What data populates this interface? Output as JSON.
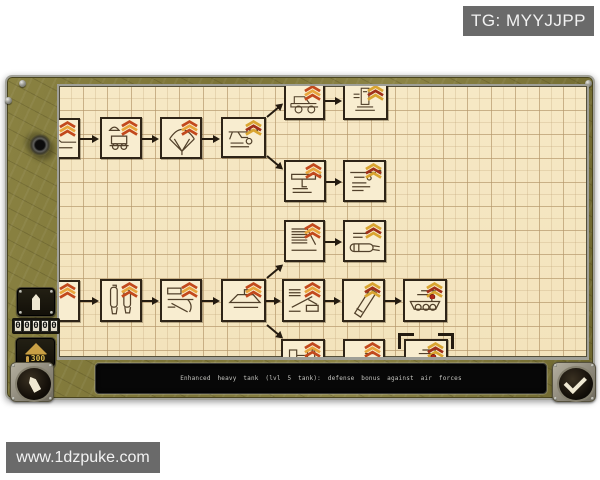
{
  "watermarks": {
    "top_right": "TG: MYYJJPP",
    "bottom_left": "www.1dzpuke.com"
  },
  "status_bar": {
    "text": "Enhanced heavy tank (lvl 5 tank): defense bonus against air forces"
  },
  "sidebar": {
    "unit_button": {
      "icon": "shell-icon"
    },
    "counter": {
      "digits": [
        "0",
        "0",
        "0",
        "0",
        "0"
      ]
    },
    "resource_badge": {
      "value": "300",
      "icon": "supply-pile-icon"
    },
    "back_button": {
      "icon": "shell-back-icon"
    }
  },
  "confirm_button": {
    "icon": "checkmark-icon"
  },
  "colors": {
    "grid_bg": "#f6e8c5",
    "grid_line": "#a68658",
    "frame_olive": "#7b7336",
    "node_border": "#2e2417",
    "insignia_orange": "#c2491d",
    "insignia_gold": "#d9a430",
    "status_text": "#c6c6c2",
    "watermark_bg": "#6a6a6a"
  },
  "tech_tree": {
    "selected_node": "f3",
    "nodes": [
      {
        "id": "a1",
        "icon": "vehicle",
        "insignia": "orange",
        "x": -20,
        "y": 32,
        "w": 41,
        "h": 41,
        "selected": false
      },
      {
        "id": "a2",
        "icon": "airborne-vehicle",
        "insignia": "orange",
        "x": 41,
        "y": 31,
        "w": 42,
        "h": 42,
        "selected": false
      },
      {
        "id": "a3",
        "icon": "parachute",
        "insignia": "orange",
        "x": 101,
        "y": 31,
        "w": 42,
        "h": 42,
        "selected": false
      },
      {
        "id": "a4",
        "icon": "rifle",
        "insignia": "gold",
        "x": 162,
        "y": 31,
        "w": 45,
        "h": 41,
        "selected": false
      },
      {
        "id": "b1a",
        "icon": "truck",
        "insignia": "orange",
        "x": 225,
        "y": -4,
        "w": 41,
        "h": 38,
        "selected": false
      },
      {
        "id": "b1b",
        "icon": "machinery",
        "insignia": "gold",
        "x": 284,
        "y": -4,
        "w": 45,
        "h": 38,
        "selected": false
      },
      {
        "id": "b2a",
        "icon": "smg",
        "insignia": "orange",
        "x": 225,
        "y": 74,
        "w": 42,
        "h": 42,
        "selected": false
      },
      {
        "id": "b2b",
        "icon": "rifle2",
        "insignia": "gold",
        "x": 284,
        "y": 74,
        "w": 43,
        "h": 42,
        "selected": false
      },
      {
        "id": "c1",
        "icon": "radiator",
        "insignia": "orange",
        "x": 225,
        "y": 134,
        "w": 41,
        "h": 42,
        "selected": false
      },
      {
        "id": "c2",
        "icon": "torpedo",
        "insignia": "gold",
        "x": 284,
        "y": 134,
        "w": 43,
        "h": 42,
        "selected": false
      },
      {
        "id": "d1",
        "icon": "partial",
        "insignia": "orange",
        "x": -20,
        "y": 194,
        "w": 41,
        "h": 42,
        "selected": false
      },
      {
        "id": "d2",
        "icon": "bombs",
        "insignia": "orange",
        "x": 41,
        "y": 193,
        "w": 42,
        "h": 43,
        "selected": false
      },
      {
        "id": "d3",
        "icon": "artillery",
        "insignia": "orange",
        "x": 101,
        "y": 193,
        "w": 42,
        "h": 43,
        "selected": false
      },
      {
        "id": "d4",
        "icon": "boat",
        "insignia": "orange",
        "x": 162,
        "y": 193,
        "w": 45,
        "h": 43,
        "selected": false
      },
      {
        "id": "e1",
        "icon": "at-gun",
        "insignia": "orange",
        "x": 223,
        "y": 193,
        "w": 43,
        "h": 43,
        "selected": false
      },
      {
        "id": "e2",
        "icon": "barrel",
        "insignia": "gold",
        "x": 283,
        "y": 193,
        "w": 43,
        "h": 43,
        "selected": false
      },
      {
        "id": "e3",
        "icon": "tank",
        "insignia": "gold-star",
        "x": 344,
        "y": 193,
        "w": 44,
        "h": 43,
        "selected": false
      },
      {
        "id": "f1",
        "icon": "tank-front",
        "insignia": "orange",
        "x": 222,
        "y": 253,
        "w": 44,
        "h": 40,
        "selected": false
      },
      {
        "id": "f2",
        "icon": "sketch",
        "insignia": "orange",
        "x": 284,
        "y": 253,
        "w": 42,
        "h": 40,
        "selected": false
      },
      {
        "id": "f3",
        "icon": "tank",
        "insignia": "gold-star",
        "x": 345,
        "y": 253,
        "w": 44,
        "h": 40,
        "selected": true
      }
    ],
    "arrows": [
      {
        "x": 21,
        "y": 52,
        "len": 13,
        "angle": 0
      },
      {
        "x": 83,
        "y": 52,
        "len": 11,
        "angle": 0
      },
      {
        "x": 143,
        "y": 52,
        "len": 12,
        "angle": 0
      },
      {
        "x": 266,
        "y": 14,
        "len": 11,
        "angle": 0
      },
      {
        "x": 267,
        "y": 95,
        "len": 10,
        "angle": 0
      },
      {
        "x": 266,
        "y": 155,
        "len": 11,
        "angle": 0
      },
      {
        "x": 21,
        "y": 214,
        "len": 13,
        "angle": 0
      },
      {
        "x": 83,
        "y": 214,
        "len": 11,
        "angle": 0
      },
      {
        "x": 143,
        "y": 214,
        "len": 12,
        "angle": 0
      },
      {
        "x": 207,
        "y": 214,
        "len": 9,
        "angle": 0
      },
      {
        "x": 266,
        "y": 214,
        "len": 10,
        "angle": 0
      },
      {
        "x": 326,
        "y": 214,
        "len": 11,
        "angle": 0
      },
      {
        "x": 208,
        "y": 30,
        "len": 15,
        "angle": -40
      },
      {
        "x": 208,
        "y": 69,
        "len": 15,
        "angle": 40
      },
      {
        "x": 208,
        "y": 191,
        "len": 15,
        "angle": -40
      },
      {
        "x": 208,
        "y": 238,
        "len": 15,
        "angle": 40
      }
    ]
  }
}
